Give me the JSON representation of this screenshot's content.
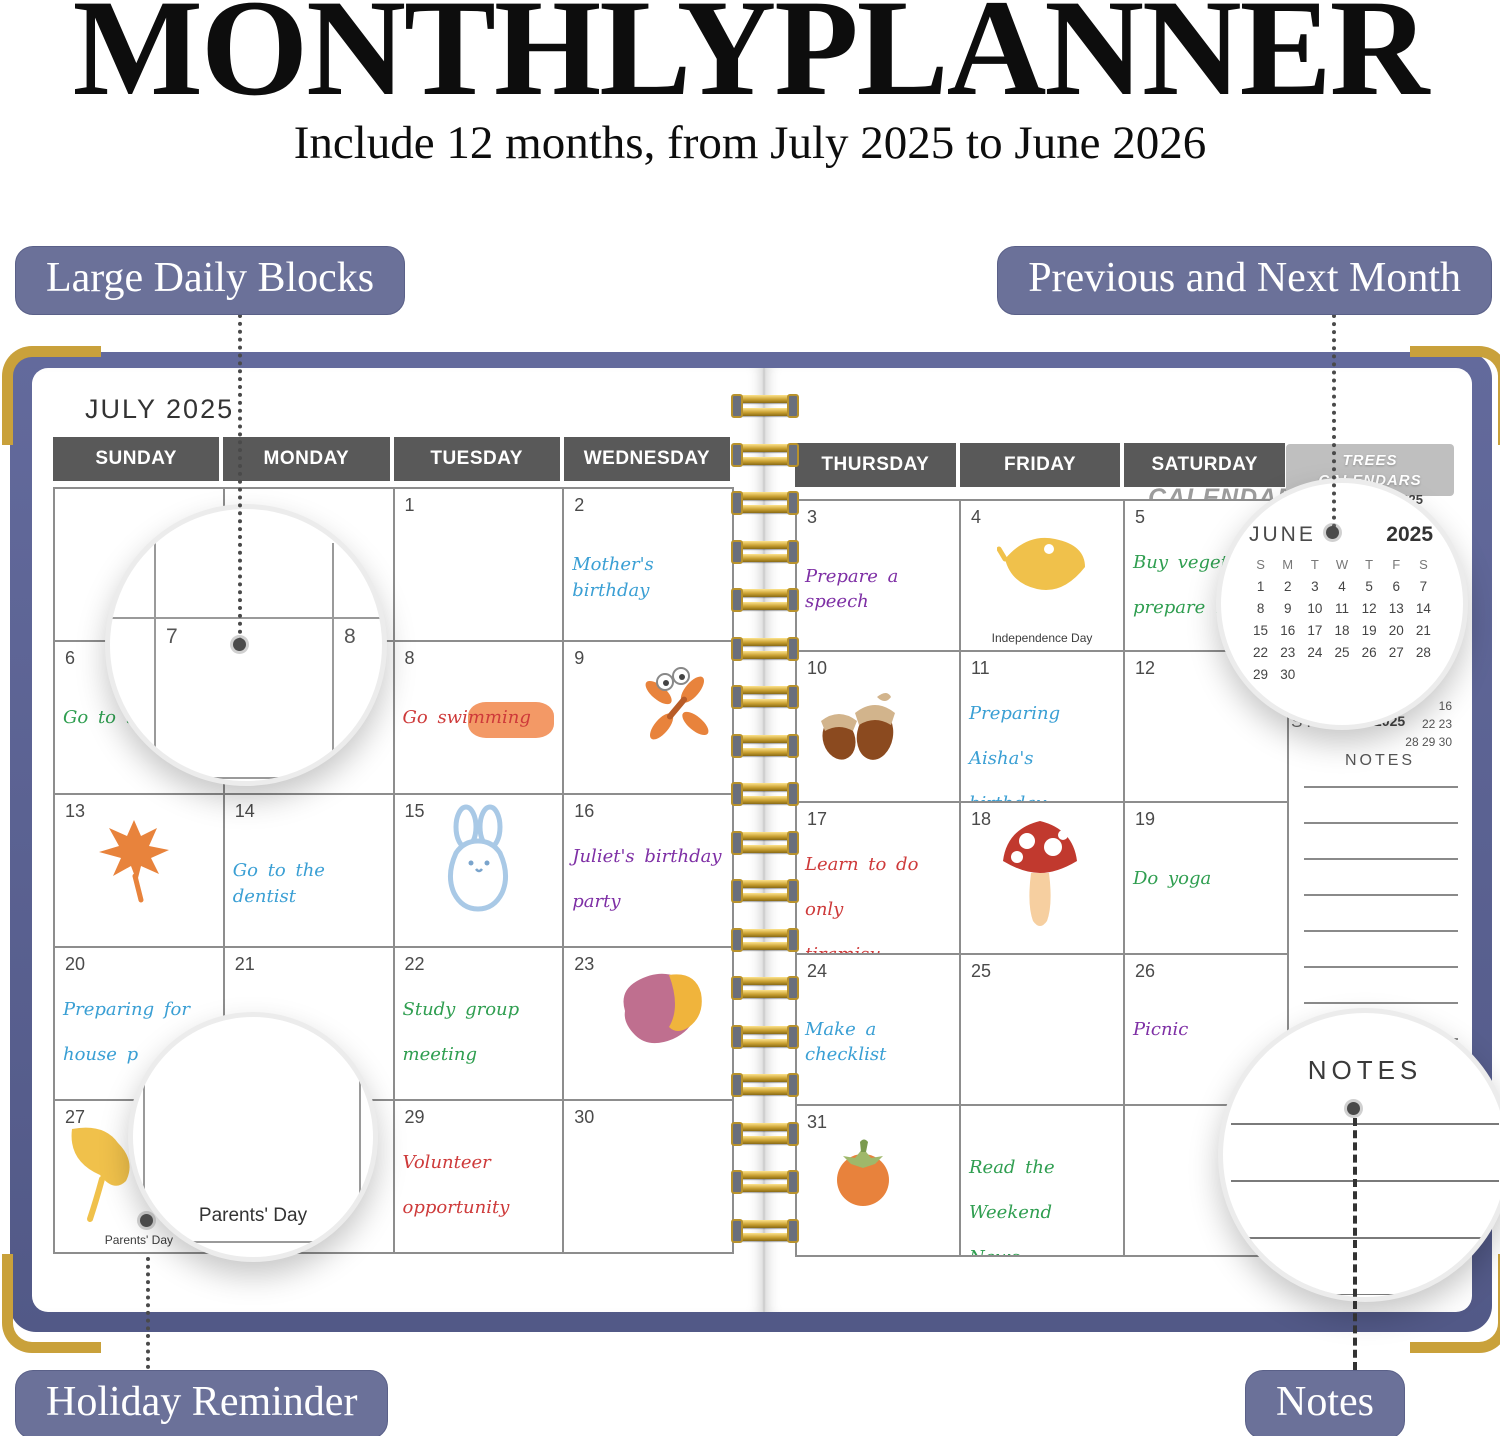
{
  "header": {
    "title": "MONTHLYPLANNER",
    "subtitle": "Include 12 months, from July 2025 to June 2026"
  },
  "callouts": {
    "large_daily_blocks": "Large Daily Blocks",
    "previous_next_month": "Previous and Next Month",
    "holiday_reminder": "Holiday Reminder",
    "notes": "Notes"
  },
  "left_page": {
    "month_title": "JULY 2025",
    "day_headers": [
      "SUNDAY",
      "MONDAY",
      "TUESDAY",
      "WEDNESDAY"
    ],
    "cells": [
      {
        "day": ""
      },
      {
        "day": ""
      },
      {
        "day": "1"
      },
      {
        "day": "2",
        "note_lines": [
          "Mother's birthday"
        ],
        "ink": "blue"
      },
      {
        "day": "6",
        "note_lines": [
          "Go to the"
        ],
        "ink": "green"
      },
      {
        "day": "7"
      },
      {
        "day": "8",
        "note_lines": [
          "Go swimming"
        ],
        "ink": "red",
        "highlight": true
      },
      {
        "day": "9",
        "illustration": "dragonfly"
      },
      {
        "day": "13",
        "illustration": "maple-leaf"
      },
      {
        "day": "14",
        "note_lines": [
          "Go to the dentist"
        ],
        "ink": "blue"
      },
      {
        "day": "15",
        "illustration": "bunny"
      },
      {
        "day": "16",
        "note_lines": [
          "Juliet's birthday",
          "party"
        ],
        "ink": "purple"
      },
      {
        "day": "20",
        "note_lines": [
          "Preparing for",
          "house p"
        ],
        "ink": "blue"
      },
      {
        "day": "21"
      },
      {
        "day": "22",
        "note_lines": [
          "Study group",
          "meeting"
        ],
        "ink": "green"
      },
      {
        "day": "23",
        "illustration": "sweet-potato"
      },
      {
        "day": "27",
        "illustration": "ginkgo-leaf",
        "holiday": "Parents' Day"
      },
      {
        "day": ""
      },
      {
        "day": "29",
        "note_lines": [
          "Volunteer",
          "opportunity"
        ],
        "ink": "red"
      },
      {
        "day": "30"
      }
    ]
  },
  "right_page": {
    "day_headers": [
      "THURSDAY",
      "FRIDAY",
      "SATURDAY"
    ],
    "brand_tab": {
      "line1": "TREES",
      "line2": "CALENDARS"
    },
    "tab_echo": "CALENDARS",
    "cells": [
      {
        "day": "3",
        "note_lines": [
          "Prepare a speech"
        ],
        "ink": "purple"
      },
      {
        "day": "4",
        "illustration": "yellow-leaf",
        "holiday": "Independence Day"
      },
      {
        "day": "5",
        "note_lines": [
          "Buy vegeta",
          "prepare m"
        ],
        "ink": "green"
      },
      {
        "day": "10",
        "illustration": "acorns"
      },
      {
        "day": "11",
        "note_lines": [
          "Preparing Aisha's",
          "birthday present"
        ],
        "ink": "blue"
      },
      {
        "day": "12"
      },
      {
        "day": "17",
        "note_lines": [
          "Learn to do only",
          "tiramisu"
        ],
        "ink": "red"
      },
      {
        "day": "18",
        "illustration": "mushroom"
      },
      {
        "day": "19",
        "note_lines": [
          "Do yoga"
        ],
        "ink": "green"
      },
      {
        "day": "24",
        "note_lines": [
          "Make a checklist"
        ],
        "ink": "blue"
      },
      {
        "day": "25"
      },
      {
        "day": "26",
        "note_lines": [
          "Picnic"
        ],
        "ink": "purple"
      },
      {
        "day": "31",
        "illustration": "persimmon"
      },
      {
        "day": "",
        "note_lines": [
          "Read the Weekend",
          "News"
        ],
        "ink": "green"
      },
      {
        "day": ""
      }
    ],
    "sidebar": {
      "june_year_partial": "2025",
      "august_label": "AUGUST",
      "august_year": "2025",
      "august_visible_rows": [
        "16",
        "22 23",
        "28 29 30"
      ],
      "notes_label": "NOTES"
    }
  },
  "magnifiers": {
    "daily_blocks": {
      "day_a": "7",
      "day_b": "8"
    },
    "holiday": {
      "text": "Parents' Day"
    },
    "june_calendar": {
      "month": "JUNE",
      "year": "2025",
      "weekday_header": [
        "S",
        "M",
        "T",
        "W",
        "T",
        "F",
        "S"
      ],
      "weeks": [
        [
          "1",
          "2",
          "3",
          "4",
          "5",
          "6",
          "7"
        ],
        [
          "8",
          "9",
          "10",
          "11",
          "12",
          "13",
          "14"
        ],
        [
          "15",
          "16",
          "17",
          "18",
          "19",
          "20",
          "21"
        ],
        [
          "22",
          "23",
          "24",
          "25",
          "26",
          "27",
          "28"
        ],
        [
          "29",
          "30",
          "",
          "",
          "",
          "",
          ""
        ]
      ]
    },
    "notes": {
      "label": "NOTES"
    }
  },
  "colors": {
    "badge": "#6b7199",
    "day_header_band": "#595959",
    "cover": "#5c6494",
    "gold_corner": "#c9a13b",
    "ink_blue": "#3a9fd4",
    "ink_green": "#2f9e50",
    "ink_red": "#ce3a3a",
    "ink_purple": "#7e2fa5"
  }
}
